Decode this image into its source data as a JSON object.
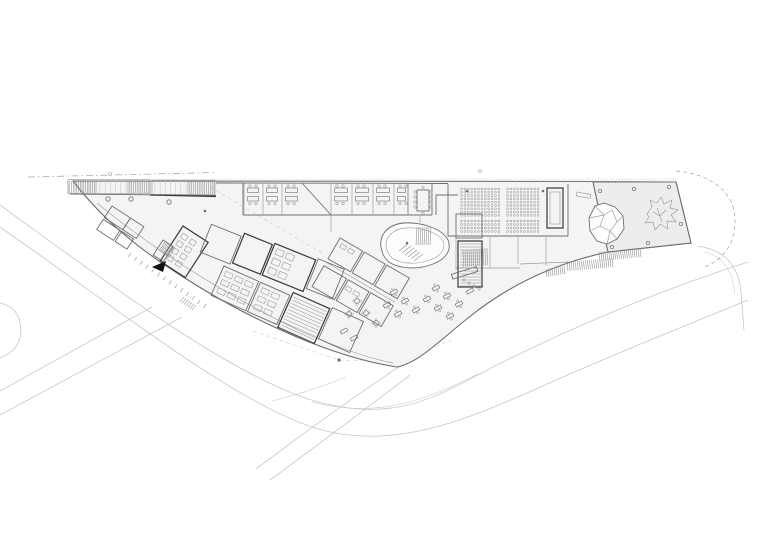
{
  "meta": {
    "drawing_type": "architectural ground floor plan",
    "description": "Black-and-white site plan of an elongated triangular building wedged between a straight street (north-west) and a curving boulevard (south), with offices, laboratories, an organic central staircase, an auditorium and a planted terrace at the east end",
    "visible_text": []
  },
  "colors": {
    "background": "#ffffff",
    "wall": "#3d3d3d",
    "wall_medium": "#6e6e6e",
    "line_light": "#9c9c9c",
    "line_faint": "#c7c7c7",
    "hatch": "#8a8a8a",
    "floor_fill": "#f4f4f4",
    "terrace_fill": "#ededed",
    "entrance_arrow": "#111111"
  },
  "zones": [
    "access-ramps-north-west",
    "entrance-lobby",
    "laboratory-cluster",
    "cellular-offices",
    "meeting-room",
    "organic-staircase-atrium",
    "auditorium",
    "stage-block",
    "service-cores",
    "cafe-terrace-seating",
    "roof-terrace-east",
    "shade-canopy",
    "tree",
    "street-north-west",
    "boulevard-south",
    "neighbour-parcel-east"
  ],
  "auditorium": {
    "seat_radius": 0.95,
    "blocks": [
      {
        "x0": 461.5,
        "y0": 189,
        "cols": 12,
        "rows": 9,
        "dx": 3.4,
        "dy": 3.3
      },
      {
        "x0": 507.5,
        "y0": 189,
        "cols": 10,
        "rows": 9,
        "dx": 3.4,
        "dy": 3.3
      },
      {
        "x0": 461.5,
        "y0": 221,
        "cols": 12,
        "rows": 4,
        "dx": 3.4,
        "dy": 3.5
      },
      {
        "x0": 507.5,
        "y0": 221,
        "cols": 10,
        "rows": 4,
        "dx": 3.4,
        "dy": 3.5
      }
    ]
  },
  "offices": {
    "band_top": 183,
    "band_bottom": 215,
    "rooms": [
      {
        "x": 244,
        "w": 19
      },
      {
        "x": 263,
        "w": 19
      },
      {
        "x": 282,
        "w": 20
      },
      {
        "x": 331,
        "w": 21
      },
      {
        "x": 352,
        "w": 21
      },
      {
        "x": 373,
        "w": 21
      },
      {
        "x": 394,
        "w": 14
      }
    ]
  },
  "ladders": [
    {
      "x1": 216,
      "y1": 178.5,
      "x2": 676,
      "y2": 178.2,
      "n": 155,
      "dx": 0,
      "dy": 4,
      "c": "line_faint",
      "w": 0.5
    },
    {
      "x1": 68,
      "y1": 181,
      "x2": 96,
      "y2": 181,
      "n": 17,
      "dx": 0,
      "dy": 12,
      "c": "hatch",
      "w": 0.55
    },
    {
      "x1": 100,
      "y1": 181,
      "x2": 126,
      "y2": 181,
      "n": 6,
      "dx": 0,
      "dy": 12,
      "c": "line_faint",
      "w": 0.55
    },
    {
      "x1": 128,
      "y1": 181,
      "x2": 150,
      "y2": 181,
      "n": 13,
      "dx": 0,
      "dy": 12,
      "c": "hatch",
      "w": 0.55
    },
    {
      "x1": 155,
      "y1": 181,
      "x2": 186,
      "y2": 181,
      "n": 7,
      "dx": 0,
      "dy": 13,
      "c": "line_faint",
      "w": 0.55
    },
    {
      "x1": 188,
      "y1": 181,
      "x2": 214,
      "y2": 181,
      "n": 15,
      "dx": 0,
      "dy": 13,
      "c": "hatch",
      "w": 0.55
    },
    {
      "x1": 599,
      "y1": 252,
      "x2": 640,
      "y2": 248,
      "n": 22,
      "dx": 1,
      "dy": 9,
      "c": "hatch",
      "w": 0.55
    },
    {
      "x1": 567,
      "y1": 262,
      "x2": 612,
      "y2": 258,
      "n": 23,
      "dx": 1,
      "dy": 9,
      "c": "hatch",
      "w": 0.55
    },
    {
      "x1": 546,
      "y1": 269,
      "x2": 564,
      "y2": 266,
      "n": 10,
      "dx": 1,
      "dy": 8,
      "c": "hatch",
      "w": 0.55
    },
    {
      "x1": 184,
      "y1": 297,
      "x2": 196,
      "y2": 305,
      "n": 7,
      "dx": -4,
      "dy": 5,
      "c": "hatch",
      "w": 0.55
    },
    {
      "x1": 131,
      "y1": 253,
      "x2": 206,
      "y2": 304,
      "n": 14,
      "dx": -2.5,
      "dy": 3.8,
      "c": "line_light",
      "w": 0.7
    },
    {
      "x1": 165.5,
      "y1": 241,
      "x2": 175,
      "y2": 247.3,
      "n": 8,
      "dx": -6.5,
      "dy": 10.1,
      "c": "hatch",
      "w": 0.55
    },
    {
      "x1": 460,
      "y1": 244,
      "x2": 460,
      "y2": 286,
      "n": 15,
      "dx": 21,
      "dy": 0,
      "c": "hatch",
      "w": 0.55
    },
    {
      "x1": 463,
      "y1": 250,
      "x2": 487,
      "y2": 248,
      "n": 13,
      "dx": 0.5,
      "dy": 17,
      "c": "hatch",
      "w": 0.55
    },
    {
      "x1": 417,
      "y1": 227,
      "x2": 431,
      "y2": 227,
      "n": 8,
      "dx": -1,
      "dy": 18,
      "c": "hatch",
      "w": 0.55
    },
    {
      "x1": 399,
      "y1": 251,
      "x2": 414,
      "y2": 261,
      "n": 6,
      "dx": 9,
      "dy": -7,
      "c": "hatch",
      "w": 0.55
    },
    {
      "x1": 293.5,
      "y1": 297,
      "x2": 279.7,
      "y2": 328,
      "n": 11,
      "dx": 32.9,
      "dy": 14.6,
      "c": "hatch",
      "w": 0.5
    }
  ],
  "grids": [
    {
      "cx": 183,
      "cy": 226,
      "rot": 33,
      "x0": 4,
      "y0": 6,
      "cols": 2,
      "rows": 4,
      "dx": 10,
      "dy": 8.5,
      "w": 6,
      "h": 5
    },
    {
      "cx": 210,
      "cy": 228,
      "rot": 22,
      "x0": 70,
      "y0": -6,
      "cols": 2,
      "rows": 3,
      "dx": 11,
      "dy": 10,
      "w": 8,
      "h": 6
    },
    {
      "cx": 224,
      "cy": 266,
      "rot": 24,
      "x0": 4,
      "y0": 4,
      "cols": 3,
      "rows": 3,
      "dx": 11,
      "dy": 9,
      "w": 8,
      "h": 5
    },
    {
      "cx": 224,
      "cy": 266,
      "rot": 24,
      "x0": 44,
      "y0": 4,
      "cols": 2,
      "rows": 3,
      "dx": 11,
      "dy": 9,
      "w": 8,
      "h": 5
    },
    {
      "cx": 340,
      "cy": 238,
      "rot": 30,
      "x0": 4,
      "y0": 4,
      "cols": 2,
      "rows": 1,
      "dx": 9,
      "dy": 0,
      "w": 6,
      "h": 4
    },
    {
      "cx": 340,
      "cy": 238,
      "rot": 30,
      "x0": 30,
      "y0": 38,
      "cols": 2,
      "rows": 1,
      "dx": 9,
      "dy": 0,
      "w": 6,
      "h": 4
    }
  ],
  "cafe_items": [
    {
      "t": "r",
      "x": 436,
      "y": 288,
      "a": -28
    },
    {
      "t": "r",
      "x": 447,
      "y": 296,
      "a": -28
    },
    {
      "t": "r",
      "x": 459,
      "y": 304,
      "a": -28
    },
    {
      "t": "r",
      "x": 427,
      "y": 299,
      "a": -28
    },
    {
      "t": "r",
      "x": 438,
      "y": 308,
      "a": -28
    },
    {
      "t": "r",
      "x": 450,
      "y": 316,
      "a": -28
    },
    {
      "t": "r",
      "x": 394,
      "y": 292,
      "a": -28
    },
    {
      "t": "r",
      "x": 405,
      "y": 301,
      "a": -28
    },
    {
      "t": "r",
      "x": 416,
      "y": 310,
      "a": -28
    },
    {
      "t": "r",
      "x": 387,
      "y": 305,
      "a": -28
    },
    {
      "t": "r",
      "x": 398,
      "y": 314,
      "a": -28
    },
    {
      "t": "c",
      "x": 357,
      "y": 301
    },
    {
      "t": "c",
      "x": 366,
      "y": 313
    },
    {
      "t": "c",
      "x": 376,
      "y": 323
    },
    {
      "t": "c",
      "x": 349,
      "y": 314
    },
    {
      "t": "l",
      "x": 344,
      "y": 331,
      "a": -28
    },
    {
      "t": "l",
      "x": 354,
      "y": 338,
      "a": -28
    },
    {
      "t": "l",
      "x": 470,
      "y": 291,
      "a": -28
    }
  ],
  "circles": {
    "lobby_columns": [
      {
        "x": 108,
        "y": 199
      },
      {
        "x": 131,
        "y": 199
      },
      {
        "x": 169,
        "y": 202
      }
    ],
    "terrace_columns": [
      {
        "x": 600,
        "y": 191
      },
      {
        "x": 634,
        "y": 189
      },
      {
        "x": 669,
        "y": 187
      },
      {
        "x": 681,
        "y": 224
      },
      {
        "x": 648,
        "y": 243
      },
      {
        "x": 612,
        "y": 247
      }
    ],
    "survey_points": [
      {
        "x": 110,
        "y": 174
      },
      {
        "x": 480,
        "y": 171
      }
    ],
    "structure_dots": [
      {
        "x": 467,
        "y": 191
      },
      {
        "x": 543,
        "y": 191
      },
      {
        "x": 407,
        "y": 243
      },
      {
        "x": 205,
        "y": 211
      },
      {
        "x": 339,
        "y": 360
      }
    ],
    "bar_stools": [
      {
        "x": 464,
        "y": 280
      },
      {
        "x": 469,
        "y": 283
      },
      {
        "x": 474,
        "y": 286
      },
      {
        "x": 479,
        "y": 289
      }
    ],
    "meeting_chairs": [
      {
        "x": 415,
        "y": 192
      },
      {
        "x": 415,
        "y": 197
      },
      {
        "x": 415,
        "y": 202
      },
      {
        "x": 415,
        "y": 207
      },
      {
        "x": 431,
        "y": 192
      },
      {
        "x": 431,
        "y": 197
      },
      {
        "x": 431,
        "y": 202
      },
      {
        "x": 431,
        "y": 207
      },
      {
        "x": 423,
        "y": 187.5
      },
      {
        "x": 423,
        "y": 213.5
      }
    ]
  }
}
